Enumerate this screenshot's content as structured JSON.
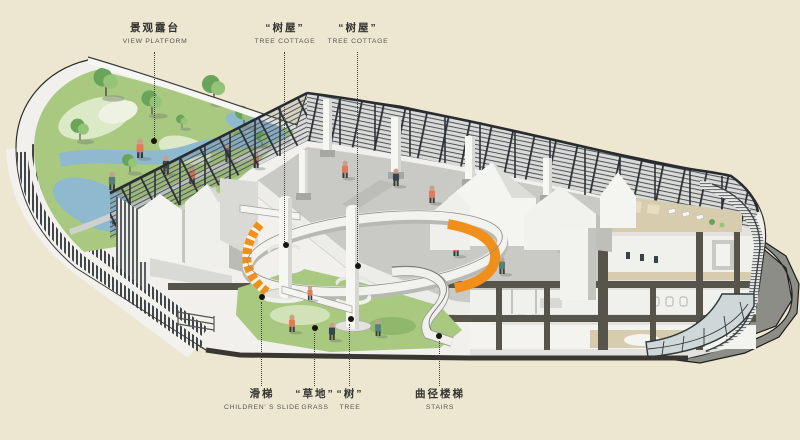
{
  "palette": {
    "bg": "#ede7d2",
    "ink": "#2f2f2c",
    "lawn": "#a9c981",
    "lawnLight": "#dce9c6",
    "lawnDark": "#85b164",
    "water": "#8fb9ce",
    "pathGrey": "#cdd2cf",
    "white": "#f6f6f3",
    "offWhite": "#ecece8",
    "faceGrey": "#dcdcd7",
    "midGrey": "#c2c2bd",
    "darkGrey": "#a2a29d",
    "slab": "#57544c",
    "slabDark": "#3a3732",
    "fence": "#2e3337",
    "fenceSlat": "#565c60",
    "court": "#c9c9c5",
    "courtShade": "#b1b1ad",
    "orange": "#f0901b",
    "tan": "#d8ccae",
    "tanLight": "#e7ddc1",
    "glass": "#cfd8d9",
    "shadow": "#8d8d88",
    "coral": "#e07a5a",
    "navy": "#39454e",
    "teal": "#53807a",
    "skin": "#c9a087",
    "treeDark": "#6aa458",
    "treeLight": "#93c47a"
  },
  "annotations": [
    {
      "zh": "景观露台",
      "en": "VIEW PLATFORM",
      "x": 155,
      "dot_x": 154,
      "dot_y": 141,
      "side": "top"
    },
    {
      "zh": "“树屋”",
      "en": "TREE COTTAGE",
      "x": 285,
      "dot_x": 286,
      "dot_y": 245,
      "side": "top"
    },
    {
      "zh": "“树屋”",
      "en": "TREE COTTAGE",
      "x": 358,
      "dot_x": 358,
      "dot_y": 266,
      "side": "top"
    },
    {
      "zh": "滑梯",
      "en": "CHILDREN' S SLIDE",
      "x": 262,
      "dot_x": 262,
      "dot_y": 297,
      "side": "bottom"
    },
    {
      "zh": "“草地”",
      "en": "GRASS",
      "x": 315,
      "dot_x": 315,
      "dot_y": 328,
      "side": "bottom"
    },
    {
      "zh": "“树”",
      "en": "TREE",
      "x": 350,
      "dot_x": 351,
      "dot_y": 319,
      "side": "bottom"
    },
    {
      "zh": "曲径楼梯",
      "en": "STAIRS",
      "x": 440,
      "dot_x": 439,
      "dot_y": 336,
      "side": "bottom"
    }
  ]
}
